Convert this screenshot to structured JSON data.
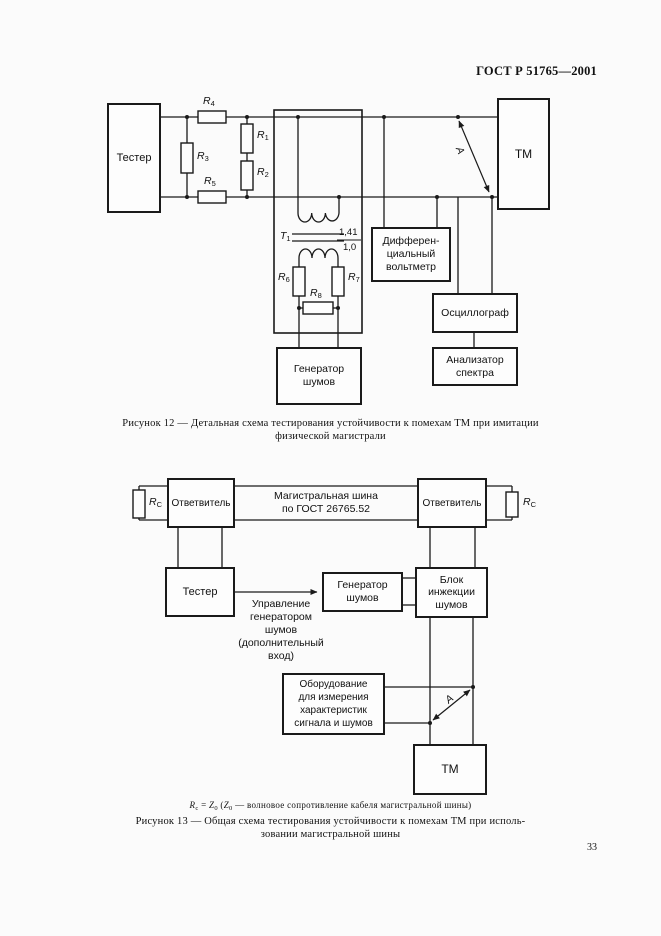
{
  "page": {
    "header": "ГОСТ Р 51765—2001",
    "number": "33"
  },
  "fig12": {
    "tester": "Тестер",
    "tm": "ТМ",
    "r1": {
      "base": "R",
      "sub": "1"
    },
    "r2": {
      "base": "R",
      "sub": "2"
    },
    "r3": {
      "base": "R",
      "sub": "3"
    },
    "r4": {
      "base": "R",
      "sub": "4"
    },
    "r5": {
      "base": "R",
      "sub": "5"
    },
    "r6": {
      "base": "R",
      "sub": "6"
    },
    "r7": {
      "base": "R",
      "sub": "7"
    },
    "r8": {
      "base": "R",
      "sub": "8"
    },
    "t1": {
      "base": "T",
      "sub": "1"
    },
    "ratio_num": "1,41",
    "ratio_den": "1,0",
    "arrow_label": "А",
    "voltmeter_l1": "Дифферен-",
    "voltmeter_l2": "циальный",
    "voltmeter_l3": "вольтметр",
    "oscilloscope": "Осциллограф",
    "noise_gen_l1": "Генератор",
    "noise_gen_l2": "шумов",
    "spectrum_l1": "Анализатор",
    "spectrum_l2": "спектра",
    "caption_l1": "Рисунок 12 — Детальная схема тестирования устойчивости к помехам ТМ при имитации",
    "caption_l2": "физической магистрали"
  },
  "fig13": {
    "coupler": "Ответвитель",
    "bus_l1": "Магистральная шина",
    "bus_l2": "по ГОСТ 26765.52",
    "rc": {
      "base": "R",
      "sub": "С"
    },
    "tester": "Тестер",
    "noise_gen_l1": "Генератор",
    "noise_gen_l2": "шумов",
    "injector_l1": "Блок",
    "injector_l2": "инжекции",
    "injector_l3": "шумов",
    "ctrl_l1": "Управление",
    "ctrl_l2": "генератором",
    "ctrl_l3": "шумов",
    "ctrl_l4": "(дополнительный",
    "ctrl_l5": "вход)",
    "equip_l1": "Оборудование",
    "equip_l2": "для измерения",
    "equip_l3": "характеристик",
    "equip_l4": "сигнала и шумов",
    "tm": "ТМ",
    "arrow_label": "А",
    "formula": {
      "r": "R",
      "r_sub": "с",
      "eq": " = ",
      "z": "Z",
      "z_sub": "0",
      "open": " (",
      "z2": "Z",
      "z2_sub": "0",
      "rest": " — волновое сопротивление кабеля магистральной шины)"
    },
    "caption_l1": "Рисунок 13 — Общая схема тестирования устойчивости к помехам ТМ при исполь-",
    "caption_l2": "зовании магистральной шины"
  }
}
